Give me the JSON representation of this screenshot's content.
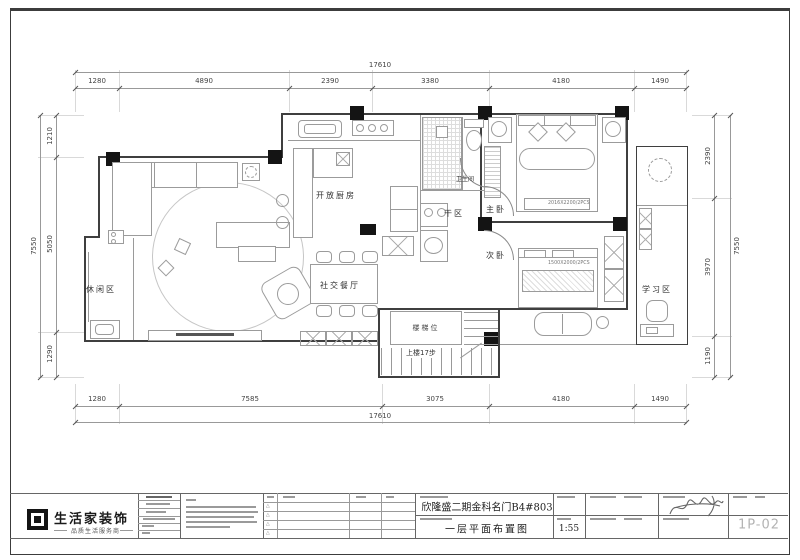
{
  "dims": {
    "top": {
      "total": "17610",
      "segments": [
        "1280",
        "4890",
        "2390",
        "3380",
        "4180",
        "1490"
      ]
    },
    "bottom": {
      "total": "17610",
      "segments": [
        "1280",
        "7585",
        "3075",
        "4180",
        "1490"
      ]
    },
    "left": {
      "total": "7550",
      "segments": [
        "1210",
        "5050",
        "1290"
      ]
    },
    "right": {
      "total": "7550",
      "segments": [
        "2390",
        "3970",
        "1190"
      ]
    }
  },
  "rooms": {
    "leisure": "休闲区",
    "kitchen": "开放厨房",
    "dry_zone": "干区",
    "bathroom": "卫生间",
    "master_bedroom": "主卧",
    "second_bedroom": "次卧",
    "study": "学习区",
    "dining": "社交餐厅",
    "stairs": "楼梯位",
    "stairs_note": "上楼17步"
  },
  "annotations": {
    "master_bed_size": "2016X2200/2PCS",
    "second_bed_size": "1500X2000/2PCS"
  },
  "titleblock": {
    "logo_text": "生活家装饰",
    "logo_tagline": "品质生活服务商",
    "project_name": "欣隆盛二期金科名门B4#803",
    "drawing_title": "一层平面布置图",
    "scale_value": "1:55",
    "sheet_no": "1P-02",
    "revision_marker": "△"
  }
}
